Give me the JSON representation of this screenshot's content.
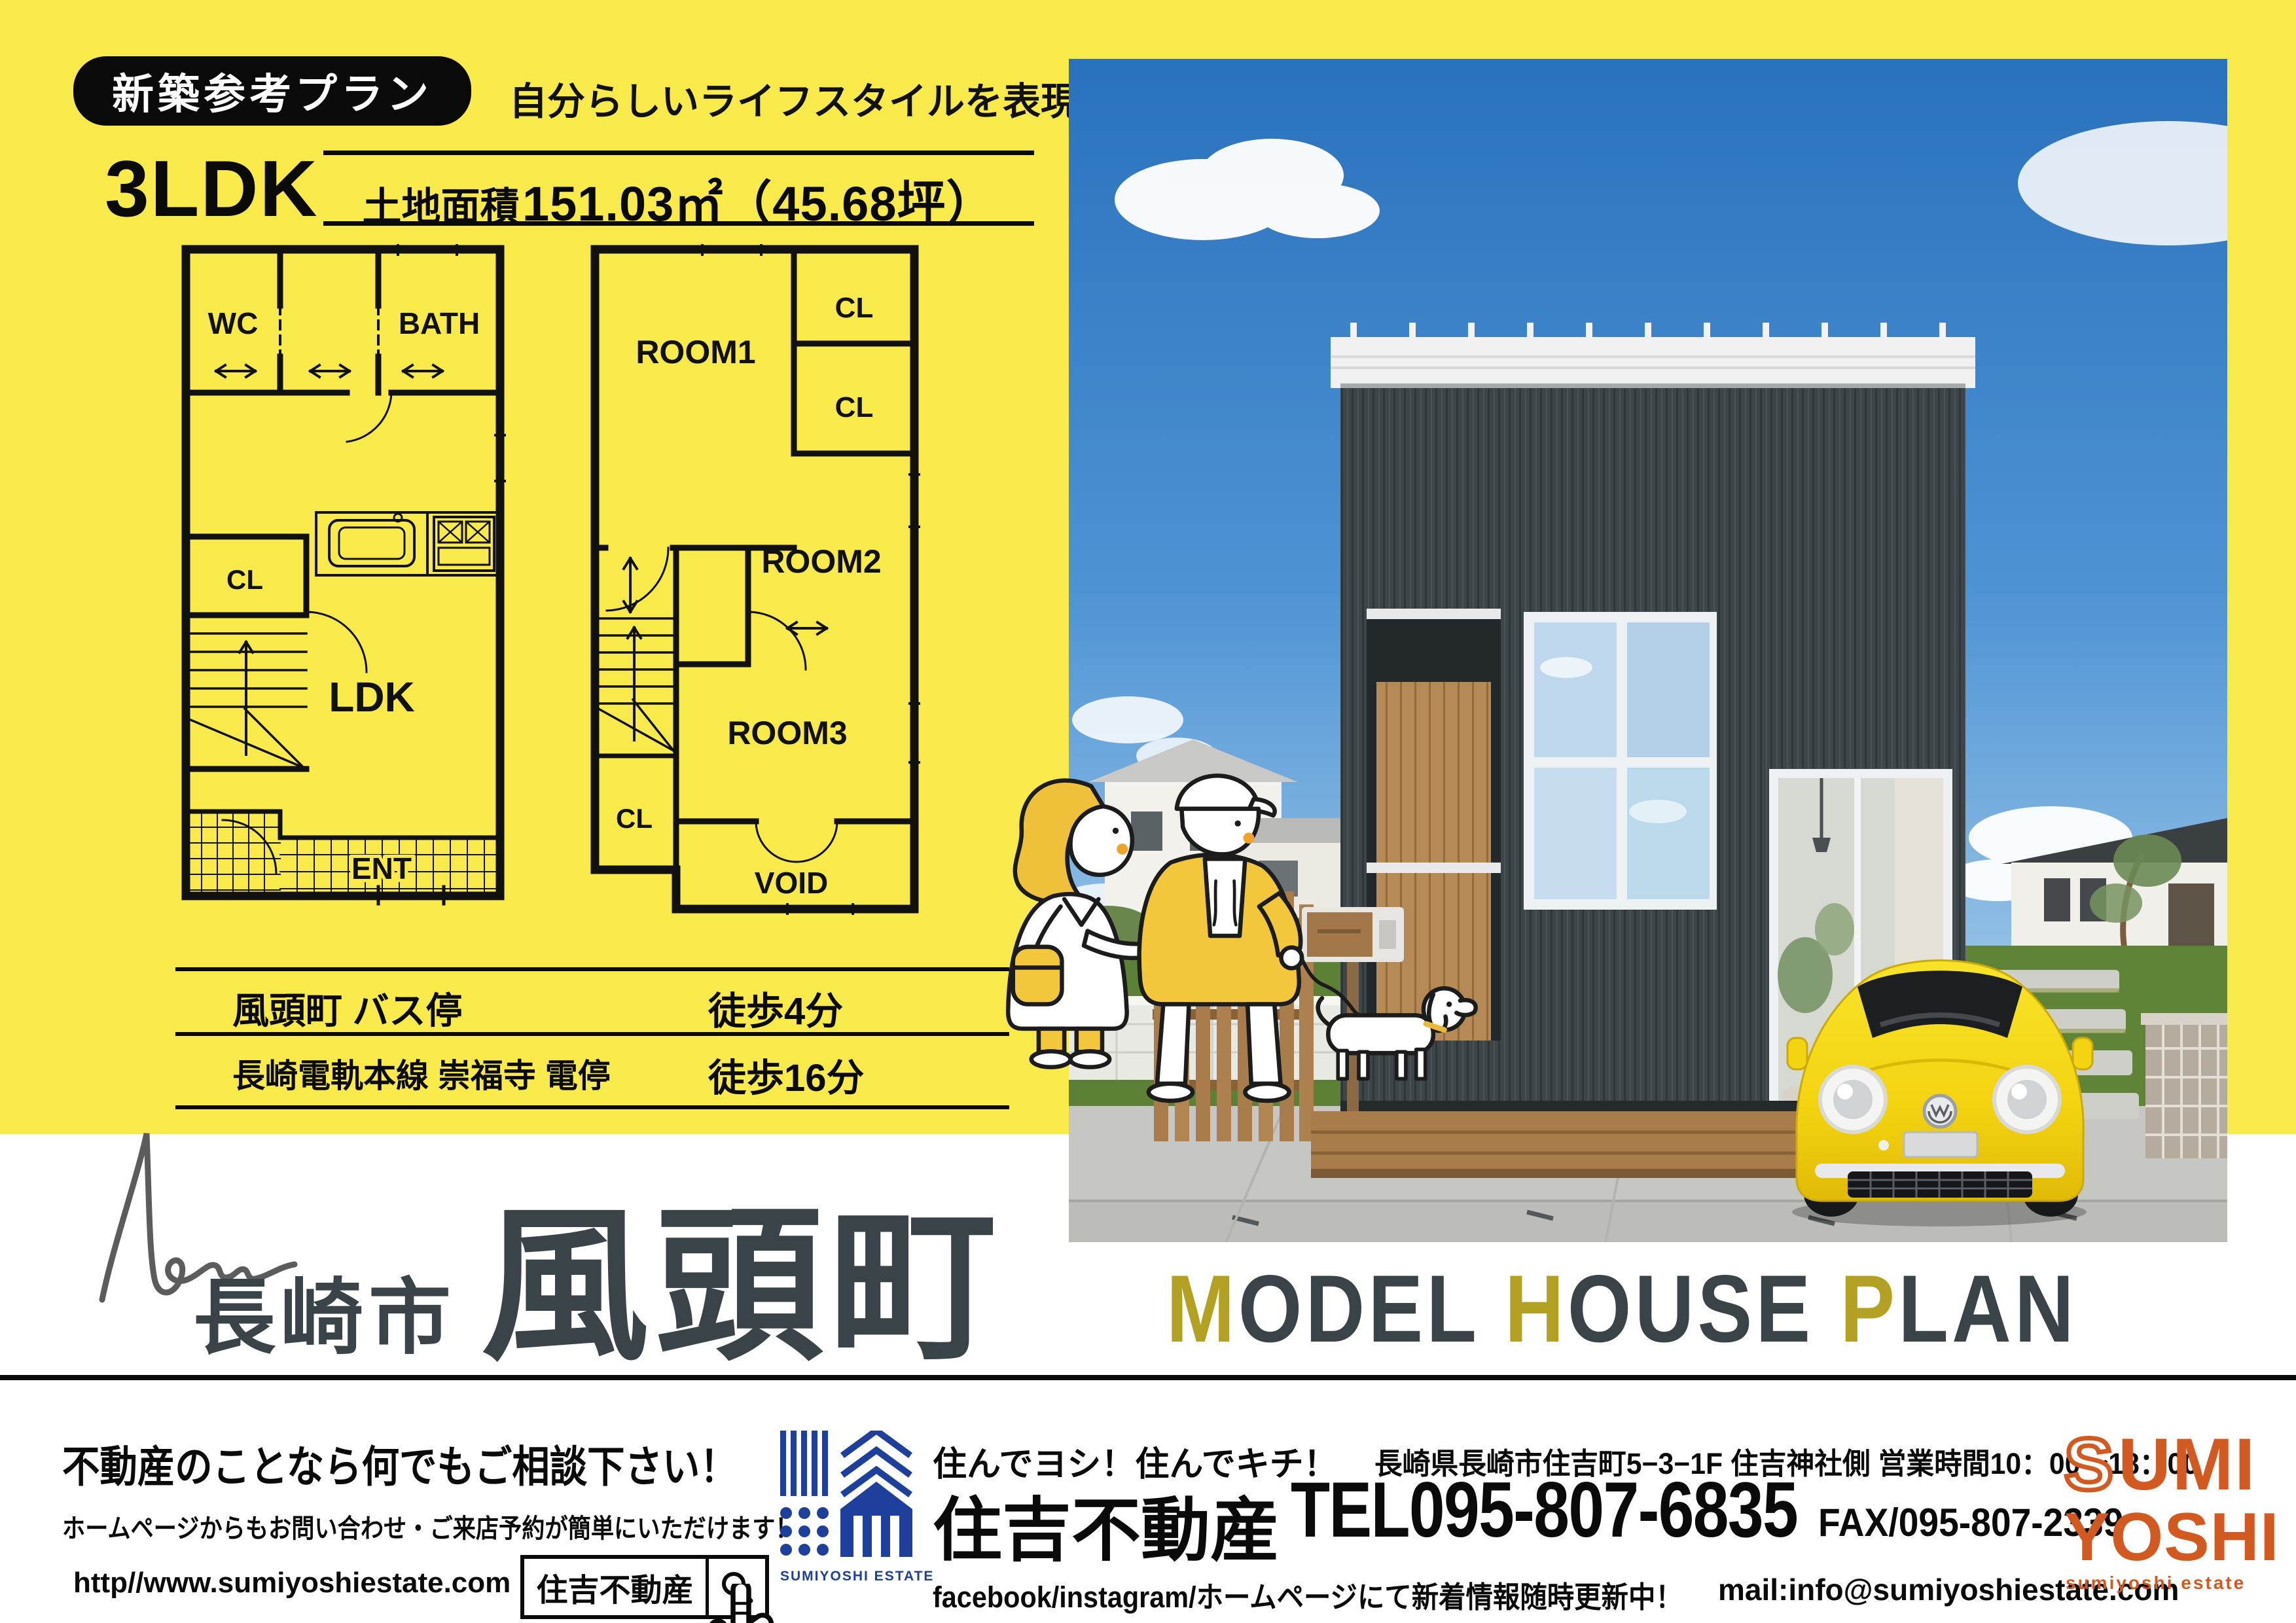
{
  "colors": {
    "yellow_bg": "#f7ea4a",
    "ink": "#0a0a0a",
    "slate_title": "#3a4347",
    "mustard_accent": "#b3a124",
    "logo_blue": "#1e3f9b",
    "logo_orange": "#d2591f",
    "sky_blue": "#2d74c0",
    "house_dark": "#3d4549",
    "car_yellow": "#f5d915"
  },
  "badge": {
    "label": "新築参考プラン"
  },
  "tagline": "自分らしいライフスタイルを表現",
  "plan": {
    "layout": "3LDK",
    "area_label": "土地面積",
    "area_value": "151.03㎡（45.68坪）"
  },
  "floor1": {
    "wc": "WC",
    "bath": "BATH",
    "cl": "CL",
    "ldk": "LDK",
    "ent": "ENT"
  },
  "floor2": {
    "room1": "ROOM1",
    "cl_a": "CL",
    "cl_b": "CL",
    "room2": "ROOM2",
    "room3": "ROOM3",
    "cl_left": "CL",
    "void_label": "VOID"
  },
  "access": {
    "rows": [
      {
        "name": "風頭町 バス停",
        "walk": "徒歩4分"
      },
      {
        "name": "長崎電軌本線 崇福寺 電停",
        "walk": "徒歩16分"
      }
    ]
  },
  "hero": {
    "script": "New",
    "city": "長崎市",
    "town": "風頭町"
  },
  "model_plan": {
    "m": "M",
    "odel": "ODEL",
    "h": "H",
    "ouse": "OUSE",
    "p": "P",
    "lan": "LAN"
  },
  "footer": {
    "consult": "不動産のことなら何でもご相談下さい！",
    "note": "ホームページからもお問い合わせ・ご来店予約が簡単にいただけます！",
    "url": "http//www.sumiyoshiestate.com",
    "search_label": "住吉不動産",
    "estate_logo_caption": "SUMIYOSHI ESTATE",
    "slogan": "住んでヨシ！住んでキチ！",
    "address": "長崎県長崎市住吉町5−3−1F 住吉神社側 営業時間10：00〜18：00",
    "company": "住吉不動産",
    "tel": "TEL095-807-6835",
    "fax": "FAX/095-807-2339",
    "sns": "facebook/instagram/ホームページにて新着情報随時更新中！",
    "mail": "mail:info@sumiyoshiestate.com",
    "brand_s": "S",
    "brand_umi": "UMI",
    "brand_yoshi": "YOSHI",
    "brand_caption": "sumiyoshi estate"
  }
}
